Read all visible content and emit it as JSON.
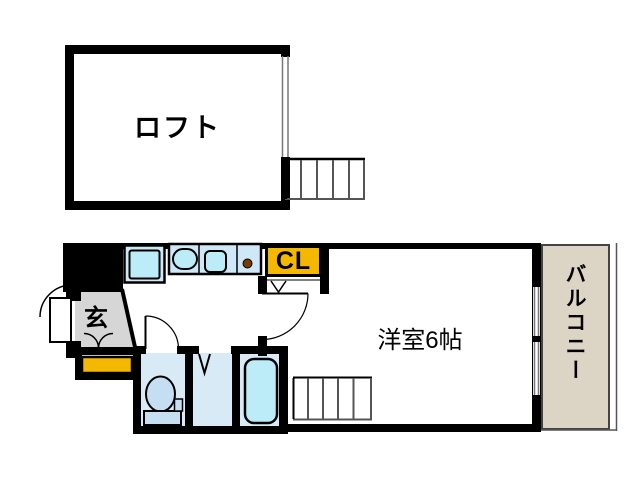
{
  "title": "apartment floor plan",
  "rooms": {
    "loft": {
      "label": "ロフト"
    },
    "entrance": {
      "label": "玄"
    },
    "closet": {
      "label": "CL"
    },
    "western_room": {
      "label": "洋室6帖"
    },
    "balcony": {
      "label": "バルコニー"
    }
  },
  "colors": {
    "wall": "#000000",
    "storage_yellow": "#F5B800",
    "balcony_beige": "#DCD4C5",
    "room_blue": "#D9EAF7",
    "fixture_cyan": "#BDECF9",
    "toilet_blue": "#C6DEF2",
    "entrance_gray": "#D6D6D6",
    "knob_brown": "#7A3B00"
  }
}
